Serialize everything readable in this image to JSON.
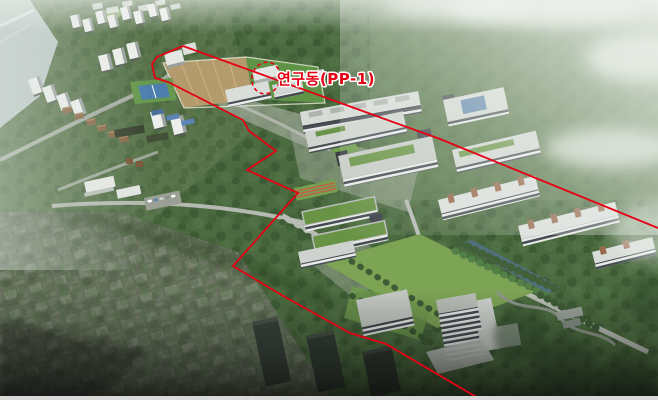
{
  "annotation": {
    "label": "연구동(PP-1)"
  },
  "colors": {
    "boundary": "#e60013",
    "label_text": "#e60013",
    "forest": "#4c6a40",
    "mist": "#edf2ec",
    "lawn": "#7da355",
    "pond": "#50707e",
    "field_dirt": "#b49b6d",
    "field_grass": "#5f9447",
    "tennis_court": "#4d7fae",
    "building_roof": "#d9ddd9",
    "accent_brown": "#96664a",
    "city_blocks": "#66705c"
  }
}
